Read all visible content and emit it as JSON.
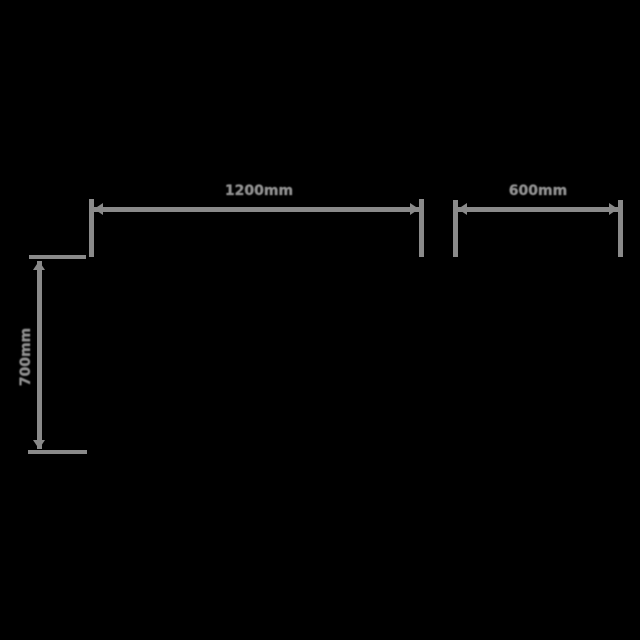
{
  "window": {
    "background_color": "#000000"
  },
  "diagram": {
    "type": "technical-dimension-drawing",
    "line_color": "#8a8a8a",
    "text_color": "#909090",
    "unit": "mm",
    "dimensions": {
      "top_width": {
        "label": "1200mm",
        "orientation": "horizontal",
        "position": "top-left"
      },
      "right_width": {
        "label": "600mm",
        "orientation": "horizontal",
        "position": "top-right"
      },
      "left_height": {
        "label": "700mm",
        "orientation": "vertical",
        "position": "left"
      }
    }
  }
}
